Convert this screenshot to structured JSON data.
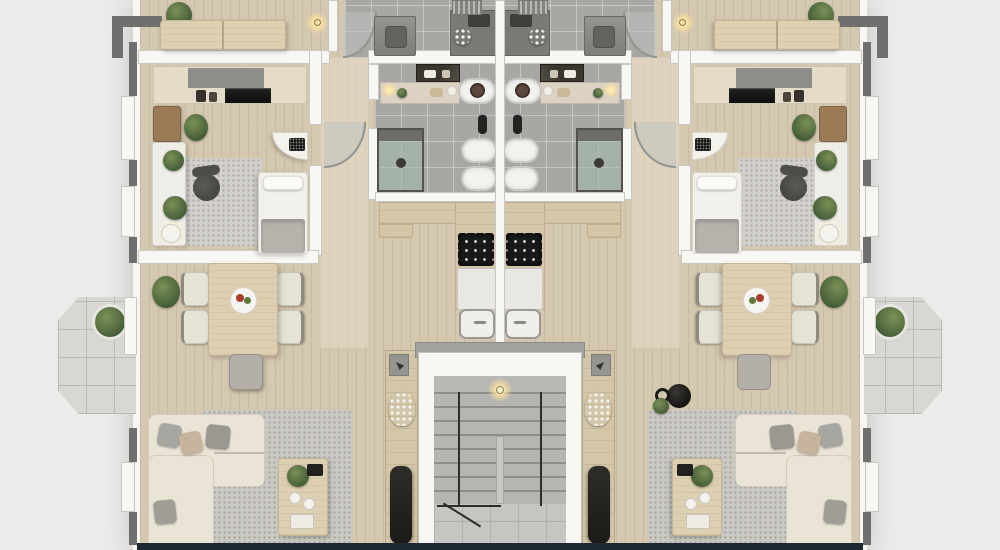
{
  "scene": {
    "type": "apartment-floor-plan-3d-top-down-render",
    "units": 2,
    "symmetry": "two mirrored apartments flanking a central stairwell",
    "visible_text": "none"
  },
  "rooms": {
    "bedroom_top": "Bedroom (cropped at top edge)",
    "study": "Study / guest room with kitchenette counter",
    "bathroom": "Bathroom",
    "utility": "Utility room",
    "kitchen": "Galley kitchen",
    "dining": "Dining area",
    "living": "Living area",
    "hallway": "Hallway",
    "stairwell": "Central stairwell",
    "balcony": "Side balcony"
  },
  "furniture": {
    "bedroom_top": [
      "wood double bed",
      "potted plant",
      "pendant lamp"
    ],
    "study": [
      "counter with black cooktop",
      "espresso machine",
      "bar cabinet",
      "white console with plants and lamp",
      "office chair",
      "gray rug",
      "single bed with gray blanket",
      "white corner desk with laptop"
    ],
    "bathroom": [
      "vanity with dark mirror",
      "freestanding oval tub",
      "wall-hung toilet",
      "bidet",
      "toilet brush",
      "glass shower enclosure"
    ],
    "utility": [
      "washing machine",
      "dark counter with decor",
      "drying rack",
      "curved glass partition"
    ],
    "kitchen": [
      "wood counter run",
      "4-burner cooktop",
      "white counter",
      "sink with faucet"
    ],
    "dining": [
      "wood dining table",
      "plate of food",
      "4 upholstered chairs",
      "gray stool",
      "corner plant"
    ],
    "living": [
      "L-shaped cream sectional sofa",
      "throw pillows",
      "speckled gray rug",
      "wood coffee table with plant, bowls and magazine",
      "entry shelf with white flowers",
      "tall dark panel",
      "black kettle decor (right unit)"
    ],
    "stairwell": [
      "concrete stair flights",
      "black metal railing",
      "ceiling light",
      "tiled landing",
      "gray door signs"
    ],
    "balcony": [
      "chamfered tile deck",
      "potted plant",
      "glass door"
    ]
  },
  "palette": {
    "background": "#ebebe9",
    "wall_white": "#f8f7f4",
    "exterior_trim_gray": "#6f6f6d",
    "wood_floor": "#d5c8b0",
    "bath_tile_gray": "#a8a7a3",
    "balcony_tile": "#d8d7d3",
    "stair_concrete": "#b6b5b1",
    "sofa_cream": "#eae4d6",
    "rug_gray": "#cbc9c4",
    "counter_wood": "#d4c6a8",
    "cooktop_black": "#181818",
    "plant_green": "#55703f",
    "base_strip_navy": "#1f2934",
    "lamp_glow": "#f5d98a"
  }
}
